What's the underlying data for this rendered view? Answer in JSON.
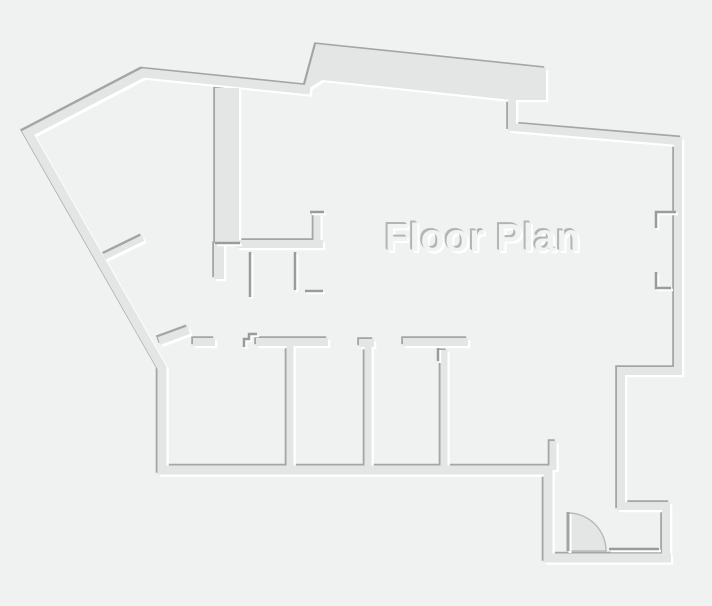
{
  "title": "Floor Plan",
  "colors": {
    "background": "#f0f1f1",
    "wall_fill": "#e4e6e6",
    "shadow_dark": "#a4a6a6",
    "highlight": "#ffffff",
    "detail_dark": "#9a9c9c",
    "door_fill": "#e4e6e6",
    "door_arc": "#b8baba",
    "door_leaf": "#a2a4a4",
    "title_fill": "#f1f2f2",
    "title_shadow": "#b4b6b6"
  },
  "canvas": {
    "width": 712,
    "height": 606
  },
  "floor_plan": {
    "outer_walls": [
      {
        "name": "left-wing-outline",
        "width": 9,
        "points": [
          [
            551,
            470
          ],
          [
            162,
            470
          ],
          [
            162,
            368
          ],
          [
            28,
            133
          ],
          [
            143,
            73
          ],
          [
            310,
            90
          ]
        ]
      },
      {
        "name": "right-outline",
        "width": 8,
        "points": [
          [
            512,
            100
          ],
          [
            512,
            127
          ],
          [
            678,
            141
          ],
          [
            678,
            371
          ],
          [
            621,
            371
          ],
          [
            621,
            506
          ],
          [
            666,
            506
          ],
          [
            666,
            557
          ]
        ]
      },
      {
        "name": "entry-outline",
        "width": 9,
        "points": [
          [
            548,
            466
          ],
          [
            548,
            558
          ],
          [
            671,
            558
          ]
        ]
      }
    ],
    "bay_polygon": {
      "name": "top-bay",
      "points": [
        [
          303,
          92
        ],
        [
          316,
          44
        ],
        [
          546,
          68
        ],
        [
          546,
          100
        ],
        [
          511,
          100
        ],
        [
          322,
          80
        ]
      ]
    },
    "inner_walls": [
      {
        "name": "shaft-slab",
        "width": 24,
        "points": [
          [
            227,
            88
          ],
          [
            227,
            243
          ]
        ]
      },
      {
        "name": "shaft-lower-wall",
        "width": 10,
        "points": [
          [
            219,
            243
          ],
          [
            219,
            279
          ]
        ]
      },
      {
        "name": "hall-top-wall",
        "width": 8,
        "points": [
          [
            237,
            244
          ],
          [
            323,
            244
          ]
        ]
      },
      {
        "name": "hall-l-wall",
        "width": 7,
        "points": [
          [
            317,
            214
          ],
          [
            317,
            244
          ]
        ]
      },
      {
        "name": "diagonal-jamb",
        "width": 6,
        "points": [
          [
            104,
            257
          ],
          [
            143,
            238
          ]
        ]
      },
      {
        "name": "room-top-diagonal",
        "width": 8,
        "points": [
          [
            159,
            341
          ],
          [
            189,
            330
          ]
        ]
      },
      {
        "name": "room-top-seg-1",
        "width": 8,
        "points": [
          [
            193,
            342
          ],
          [
            215,
            342
          ]
        ]
      },
      {
        "name": "room-top-seg-2",
        "width": 8,
        "points": [
          [
            256,
            342
          ],
          [
            328,
            342
          ]
        ]
      },
      {
        "name": "room-top-seg-3",
        "width": 8,
        "points": [
          [
            359,
            343
          ],
          [
            374,
            343
          ]
        ]
      },
      {
        "name": "room-top-seg-4",
        "width": 8,
        "points": [
          [
            403,
            342
          ],
          [
            468,
            342
          ]
        ]
      },
      {
        "name": "divider-1",
        "width": 7,
        "points": [
          [
            290,
            346
          ],
          [
            290,
            467
          ]
        ]
      },
      {
        "name": "divider-2",
        "width": 7,
        "points": [
          [
            368,
            347
          ],
          [
            368,
            467
          ]
        ]
      },
      {
        "name": "divider-3",
        "width": 7,
        "points": [
          [
            444,
            350
          ],
          [
            444,
            467
          ]
        ]
      },
      {
        "name": "entry-jamb-stub",
        "width": 7,
        "points": [
          [
            553,
            441
          ],
          [
            553,
            470
          ]
        ]
      }
    ],
    "thin_details": [
      {
        "name": "step-zigzag",
        "points": [
          [
            257,
            334
          ],
          [
            249,
            334
          ],
          [
            249,
            339
          ],
          [
            244,
            339
          ],
          [
            244,
            347
          ]
        ]
      },
      {
        "name": "stair-stub-1",
        "points": [
          [
            250,
            252
          ],
          [
            250,
            297
          ]
        ]
      },
      {
        "name": "stair-stub-2",
        "points": [
          [
            295,
            252
          ],
          [
            295,
            290
          ]
        ]
      },
      {
        "name": "stair-stub-3",
        "points": [
          [
            305,
            291
          ],
          [
            323,
            291
          ]
        ]
      },
      {
        "name": "hall-l-cap",
        "points": [
          [
            310,
            212
          ],
          [
            324,
            212
          ]
        ]
      },
      {
        "name": "divider-3-stub",
        "points": [
          [
            438,
            348
          ],
          [
            438,
            361
          ]
        ]
      },
      {
        "name": "slab-bottom-edge",
        "points": [
          [
            215,
            243
          ],
          [
            240,
            243
          ]
        ]
      },
      {
        "name": "right-wall-notch-1",
        "points": [
          [
            676,
            212
          ],
          [
            656,
            212
          ],
          [
            656,
            228
          ]
        ]
      },
      {
        "name": "right-wall-notch-2",
        "points": [
          [
            656,
            272
          ],
          [
            656,
            288
          ],
          [
            671,
            288
          ]
        ]
      },
      {
        "name": "door-threshold",
        "points": [
          [
            609,
            549
          ],
          [
            659,
            549
          ]
        ]
      }
    ],
    "door": {
      "wedge_path": "M 568,513 A 38,38 0 0 1 606,551 L 568,551 Z",
      "leaf": [
        [
          568,
          512
        ],
        [
          568,
          551
        ]
      ]
    }
  }
}
